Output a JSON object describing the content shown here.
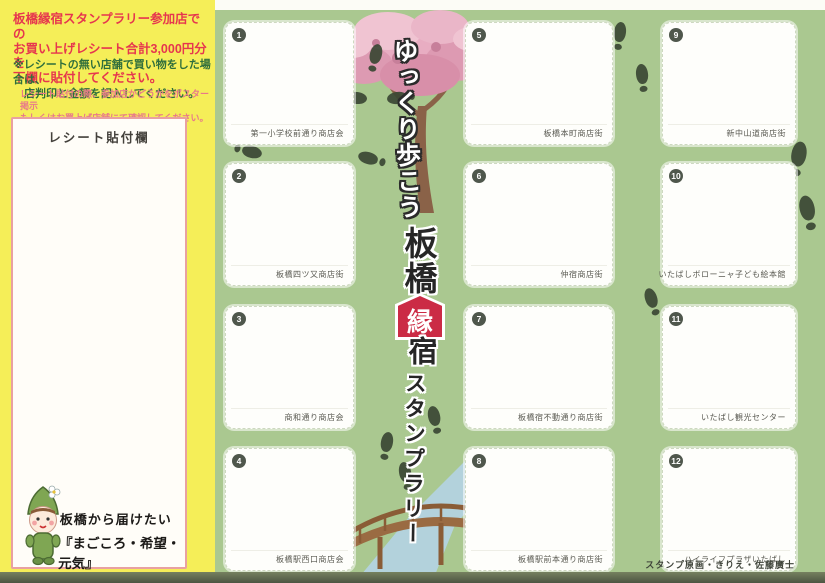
{
  "card": {
    "sidebar": {
      "notice_lines": [
        "板橋縁宿スタンプラリー参加店での",
        "お買い上げレシート合計3,000円分を",
        "下欄に貼付してください。"
      ],
      "note_lines": [
        "※レシートの無い店舗で買い物をした場合は、",
        "　店判印と金額を記入してください。"
      ],
      "subnote_lines": [
        "レシート貼付の際、参加店かどうかをポスター掲示",
        "もしくはお買上げ店舗にて確認してください。"
      ],
      "receipt_label": "レシート貼付欄",
      "slogan_lines": [
        "板橋から届けたい",
        "『まごころ・希望・元気』"
      ],
      "mascot_icon": "itabashi-green-child-mascot"
    },
    "title": {
      "walk": "ゆっくり歩こう",
      "itabashi": "板橋",
      "en": "縁",
      "juku": "宿",
      "rally": "スタンプラリー"
    },
    "stamps": [
      {
        "number": "1",
        "label": "第一小学校前通り商店会"
      },
      {
        "number": "2",
        "label": "板橋四ツ又商店街"
      },
      {
        "number": "3",
        "label": "商和通り商店会"
      },
      {
        "number": "4",
        "label": "板橋駅西口商店会"
      },
      {
        "number": "5",
        "label": "板橋本町商店街"
      },
      {
        "number": "6",
        "label": "仲宿商店街"
      },
      {
        "number": "7",
        "label": "板橋宿不動通り商店街"
      },
      {
        "number": "8",
        "label": "板橋駅前本通り商店街"
      },
      {
        "number": "9",
        "label": "新中山道商店街"
      },
      {
        "number": "10",
        "label": "いたばしボローニャ子ども絵本館"
      },
      {
        "number": "11",
        "label": "いたばし観光センター"
      },
      {
        "number": "12",
        "label": "ハイライフプラザいたばし"
      }
    ],
    "credit": "スタンプ原画・きりえ・佐藤廣士",
    "decor_icons": [
      "cherry-blossom-tree",
      "footprints-trail",
      "wooden-bridge",
      "river"
    ],
    "colors": {
      "sidebar_yellow": "#f5ee58",
      "main_green": "#aac890",
      "notice_red": "#e6364e",
      "note_green": "#2f6e3c",
      "subnote_pink": "#e8798a",
      "receipt_border_pink": "#e9a1a1",
      "ema_red": "#cb2b45",
      "footprint_dark": "#3b4734",
      "bridge_brown": "#9a6b42",
      "river_blue": "#b3d3e0",
      "blossom_pink": "#eab6c8",
      "bottom_strip": "#5d6850"
    }
  }
}
